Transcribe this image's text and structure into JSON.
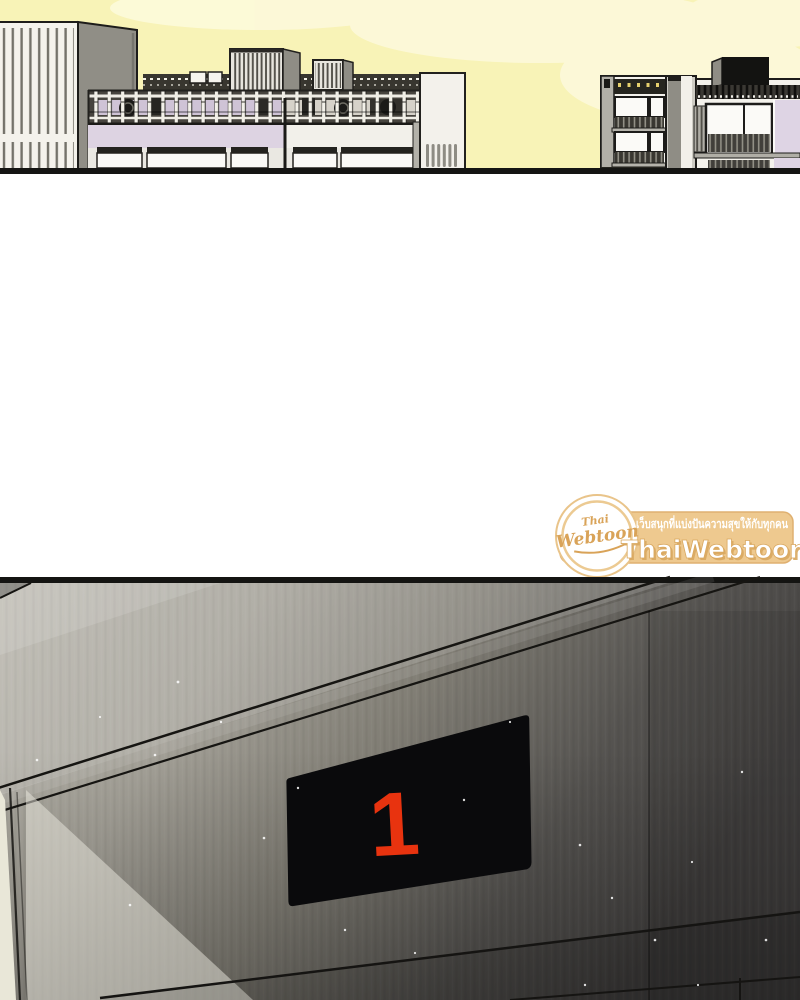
{
  "comic": {
    "panel_top": "city-skyline",
    "panel_bottom": "elevator-lobby-wall"
  },
  "floor_display": {
    "value": "1"
  },
  "watermark": {
    "tagline": "เว็บสนุกที่แบ่งปันความสุขให้กับทุกคน",
    "brand": "ThaiWebtoon",
    "logo_line1": "Thai",
    "logo_line2": "Webtoon"
  },
  "palette": {
    "sky": "#f8f3b7",
    "cloud": "#fdfadd",
    "building_white": "#f4f2ec",
    "building_gray": "#908e86",
    "lavender": "#ddd3e2",
    "outline": "#1d1c1a",
    "wall_light": "#b7b4aa",
    "wall_dark": "#434140",
    "display_black": "#0a0a0c",
    "display_red": "#e8330f",
    "watermark_tan": "#eec98f",
    "watermark_script": "#d9a358",
    "watermark_text": "#ffffff"
  }
}
